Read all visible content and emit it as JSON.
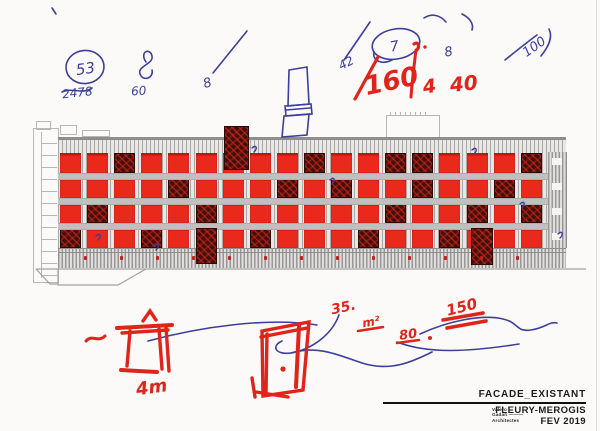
{
  "title_block": {
    "drawing_name": "FACADE_EXISTANT",
    "project": "FLEURY-MEROGIS",
    "date": "FEV 2019",
    "firm_line1": "Valero",
    "firm_line2": "Gadan ———",
    "firm_line3": "Architectes"
  },
  "annotations": {
    "blue": {
      "circled": "53",
      "scribble_num": "2478",
      "sixty": "60",
      "eight_a": "8",
      "fortytwo": "42",
      "circled7": "7",
      "eight_b": "8",
      "hundred": "100"
    },
    "red": {
      "big": "160",
      "four": "4",
      "forty": "40",
      "thirty_five": "35.",
      "sqm": "m²",
      "eighty": "80",
      "one_fifty": "150",
      "four_m": "4m"
    }
  },
  "facade": {
    "left": 60,
    "top": 153,
    "cols": 18,
    "rows": 4,
    "col_pitch": 27.1,
    "row_pitch": 25,
    "win_w": 21,
    "win_h": 20,
    "dark_cells": [
      [
        0,
        2
      ],
      [
        0,
        9
      ],
      [
        0,
        12
      ],
      [
        0,
        13
      ],
      [
        0,
        17
      ],
      [
        1,
        4
      ],
      [
        1,
        8
      ],
      [
        1,
        10
      ],
      [
        1,
        13
      ],
      [
        1,
        16
      ],
      [
        2,
        1
      ],
      [
        2,
        5
      ],
      [
        2,
        12
      ],
      [
        2,
        15
      ],
      [
        2,
        17
      ],
      [
        3,
        0
      ],
      [
        3,
        3
      ],
      [
        3,
        7
      ],
      [
        3,
        11
      ],
      [
        3,
        14
      ]
    ],
    "tall_overlays": [
      {
        "x": 224,
        "y": 126,
        "w": 25,
        "h": 44
      },
      {
        "x": 196,
        "y": 228,
        "w": 21,
        "h": 36
      },
      {
        "x": 471,
        "y": 228,
        "w": 22,
        "h": 37
      }
    ],
    "hbar_ys": [
      173,
      198,
      223
    ],
    "dots": {
      "count": 13,
      "start_x": 84,
      "pitch": 36,
      "y": 256
    }
  },
  "colors": {
    "paper": "#fbfaf9",
    "blue": "#3c3f9c",
    "red": "#e0241a",
    "window_red": "#e8291b",
    "window_dark": "#42100b",
    "mullion": "#c1c0be",
    "line_gray": "#a3a2a0"
  }
}
